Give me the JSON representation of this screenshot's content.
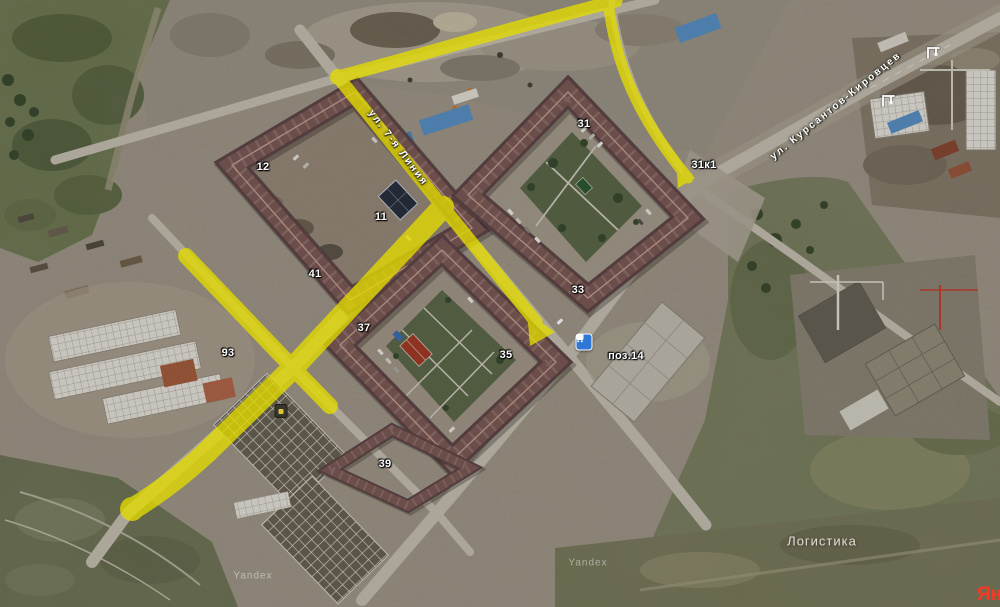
{
  "map": {
    "provider": "Yandex",
    "logo_text": "Яндекс",
    "route_color": "#e4dc00",
    "roof_color": "#7e5b57",
    "building_labels": [
      {
        "text": "12",
        "x": 263,
        "y": 167
      },
      {
        "text": "11",
        "x": 381,
        "y": 217
      },
      {
        "text": "41",
        "x": 315,
        "y": 274
      },
      {
        "text": "93",
        "x": 228,
        "y": 353
      },
      {
        "text": "31",
        "x": 584,
        "y": 124
      },
      {
        "text": "31к1",
        "x": 704,
        "y": 165
      },
      {
        "text": "33",
        "x": 578,
        "y": 290
      },
      {
        "text": "37",
        "x": 364,
        "y": 328
      },
      {
        "text": "35",
        "x": 506,
        "y": 355
      },
      {
        "text": "39",
        "x": 385,
        "y": 464
      },
      {
        "text": "поз.14",
        "x": 626,
        "y": 356
      }
    ],
    "street_labels": [
      {
        "text": "ул. 7-я Линия",
        "x": 398,
        "y": 148,
        "angle": 53
      },
      {
        "text": "ул. Курсантов-Кировцев",
        "x": 836,
        "y": 106,
        "angle": -39
      }
    ],
    "area_labels": [
      {
        "text": "Логистика",
        "x": 822,
        "y": 541
      }
    ],
    "watermarks": [
      {
        "text": "Yandex",
        "x": 253,
        "y": 576
      },
      {
        "text": "Yandex",
        "x": 588,
        "y": 563
      }
    ],
    "icons": [
      {
        "name": "bus-stop-icon",
        "x": 584,
        "y": 342
      },
      {
        "name": "crane-icon",
        "x": 925,
        "y": 44
      },
      {
        "name": "crane-icon",
        "x": 880,
        "y": 92
      },
      {
        "name": "poi-icon",
        "x": 281,
        "y": 411
      }
    ]
  }
}
